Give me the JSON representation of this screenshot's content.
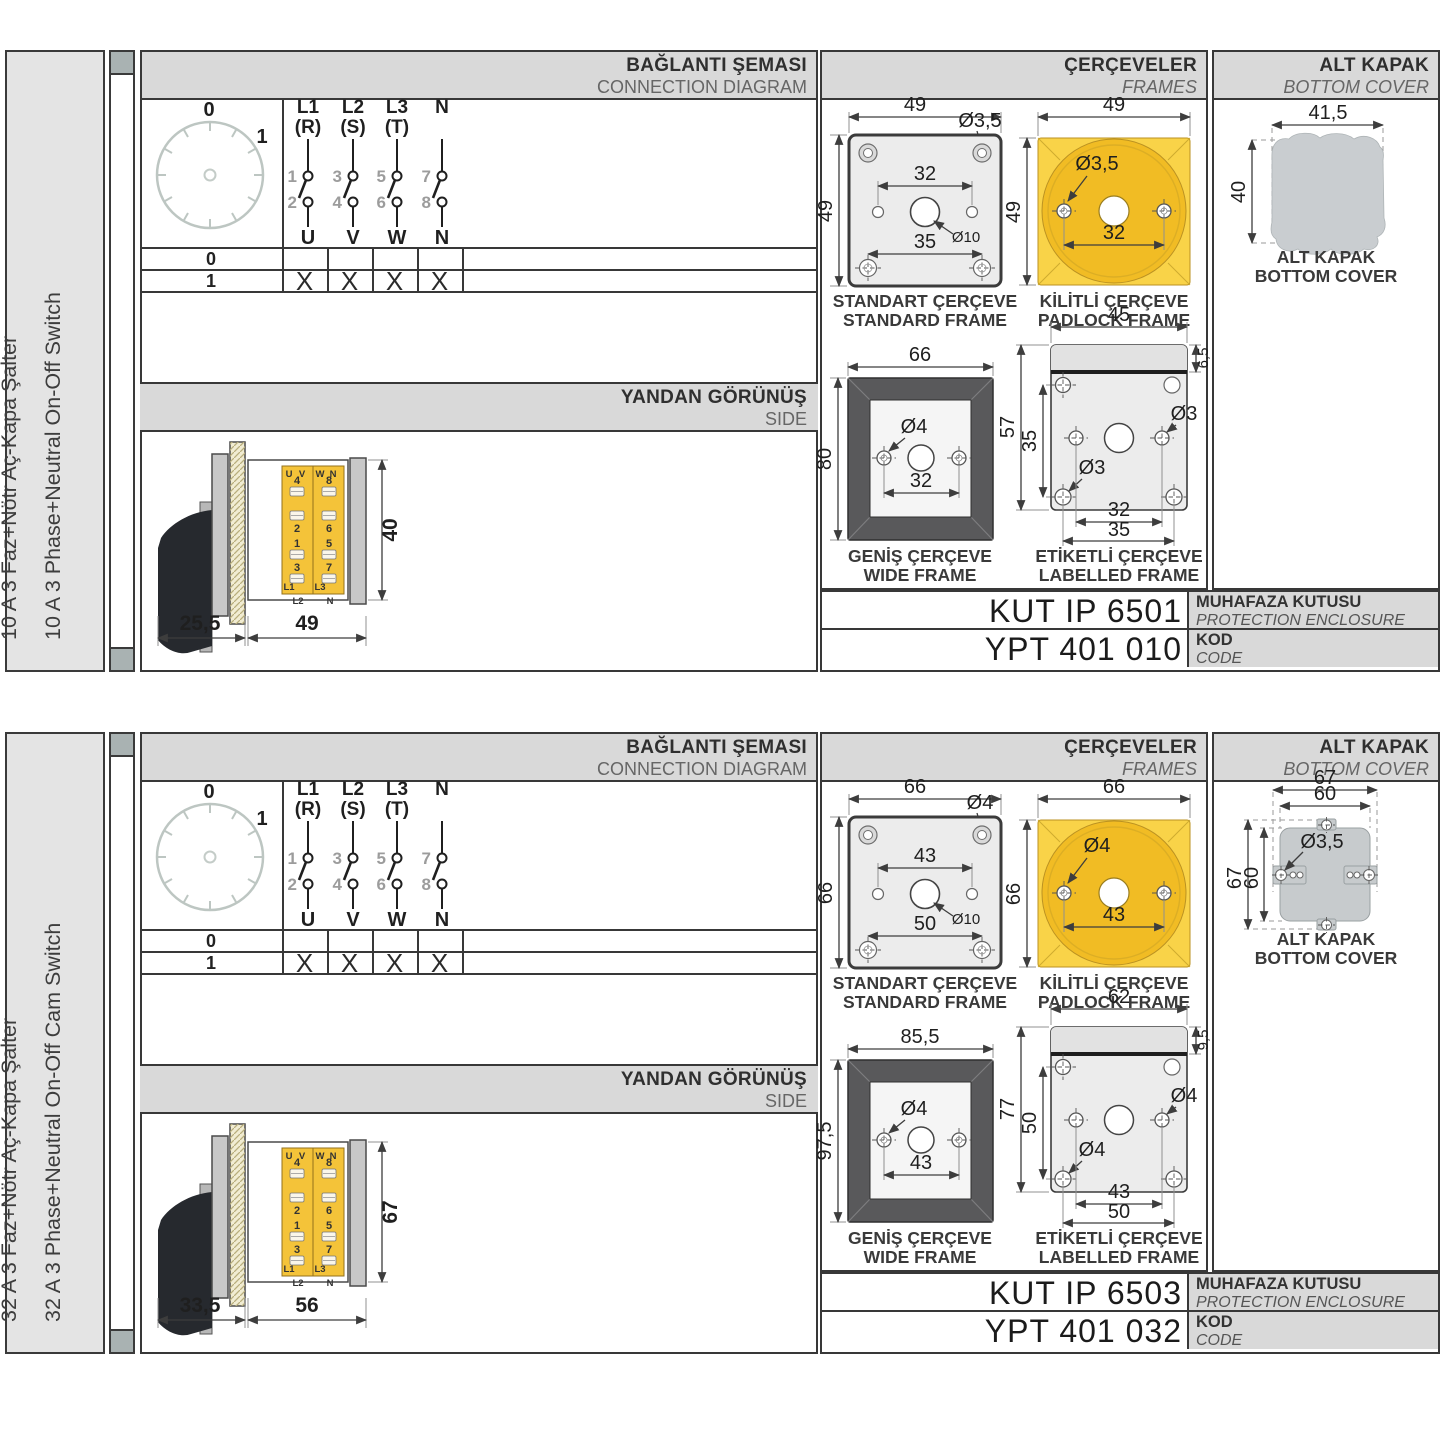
{
  "headers": {
    "connection": {
      "tr": "BAĞLANTI ŞEMASI",
      "en": "CONNECTION DIAGRAM"
    },
    "frames": {
      "tr": "ÇERÇEVELER",
      "en": "FRAMES"
    },
    "bottom_cover": {
      "tr": "ALT KAPAK",
      "en": "BOTTOM COVER"
    },
    "side": {
      "tr": "YANDAN GÖRÜNÜŞ",
      "en": "SIDE"
    }
  },
  "diagram": {
    "positions": [
      "0",
      "1"
    ],
    "poles": [
      {
        "line1": "L1",
        "line2": "(R)",
        "n_top": "1",
        "n_bottom": "2",
        "out": "U"
      },
      {
        "line1": "L2",
        "line2": "(S)",
        "n_top": "3",
        "n_bottom": "4",
        "out": "V"
      },
      {
        "line1": "L3",
        "line2": "(T)",
        "n_top": "5",
        "n_bottom": "6",
        "out": "W"
      },
      {
        "line1": "N",
        "line2": "",
        "n_top": "7",
        "n_bottom": "8",
        "out": "N"
      }
    ],
    "table": {
      "rows": [
        {
          "label": "0",
          "cells": [
            "",
            "",
            "",
            ""
          ]
        },
        {
          "label": "1",
          "cells": [
            "X",
            "X",
            "X",
            "X"
          ]
        }
      ]
    }
  },
  "captions": {
    "standard": {
      "tr": "STANDART ÇERÇEVE",
      "en": "STANDARD FRAME"
    },
    "padlock": {
      "tr": "KİLİTLİ ÇERÇEVE",
      "en": "PADLOCK FRAME"
    },
    "wide": {
      "tr": "GENİŞ ÇERÇEVE",
      "en": "WIDE FRAME"
    },
    "labelled": {
      "tr": "ETİKETLİ ÇERÇEVE",
      "en": "LABELLED FRAME"
    },
    "bottom_cover": {
      "tr": "ALT KAPAK",
      "en": "BOTTOM COVER"
    }
  },
  "codes_labels": {
    "enclosure": {
      "tr": "MUHAFAZA KUTUSU",
      "en": "PROTECTION ENCLOSURE"
    },
    "code": {
      "tr": "KOD",
      "en": "CODE"
    }
  },
  "side_terminals": {
    "u": "U",
    "v": "V",
    "w": "W",
    "n": "N",
    "t4": "4",
    "t2": "2",
    "t1": "1",
    "t3": "3",
    "t8": "8",
    "t6": "6",
    "t5": "5",
    "t7": "7",
    "l1": "L1",
    "l2": "L2",
    "l3": "L3",
    "nn": "N"
  },
  "colors": {
    "accent_yellow": "#f1bc24",
    "frame_gray": "#59595b",
    "header_gray": "#d9d9d9"
  },
  "sections": [
    {
      "label_tr": "10 A 3 Faz+Nötr Aç-Kapa Şalter",
      "label_en": "10 A 3 Phase+Neutral On-Off Switch",
      "side": {
        "front": "25,5",
        "body": "49",
        "height": "40"
      },
      "std": {
        "w": "49",
        "h": "49",
        "hole": "Ø3,5",
        "top": "32",
        "center": "Ø10",
        "bottom": "35"
      },
      "pad": {
        "w": "49",
        "h": "49",
        "hole": "Ø3,5",
        "dim": "32"
      },
      "wide": {
        "w": "66",
        "h": "80",
        "hole": "Ø4",
        "dim": "32"
      },
      "lab": {
        "w": "45",
        "strip": "6,5",
        "h": "57",
        "mid": "35",
        "hole1": "Ø3",
        "hole2": "Ø3",
        "dim1": "32",
        "dim2": "35"
      },
      "ak": {
        "w": "41,5",
        "h": "40"
      },
      "enclosure": "KUT IP 6501",
      "code": "YPT 401 010"
    },
    {
      "label_tr": "32 A 3 Faz+Nötr Aç-Kapa Şalter",
      "label_en": "32 A 3 Phase+Neutral On-Off Cam Switch",
      "side": {
        "front": "33,5",
        "body": "56",
        "height": "67"
      },
      "std": {
        "w": "66",
        "h": "66",
        "hole": "Ø4",
        "top": "43",
        "center": "Ø10",
        "bottom": "50"
      },
      "pad": {
        "w": "66",
        "h": "66",
        "hole": "Ø4",
        "dim": "43"
      },
      "wide": {
        "w": "85,5",
        "h": "97,5",
        "hole": "Ø4",
        "dim": "43"
      },
      "lab": {
        "w": "62",
        "strip": "9,5",
        "h": "77",
        "mid": "50",
        "hole1": "Ø4",
        "hole2": "Ø4",
        "dim1": "43",
        "dim2": "50"
      },
      "akb": {
        "ow": "67",
        "iw": "60",
        "oh": "67",
        "ih": "60",
        "hole": "Ø3,5"
      },
      "enclosure": "KUT IP 6503",
      "code": "YPT 401 032"
    }
  ]
}
